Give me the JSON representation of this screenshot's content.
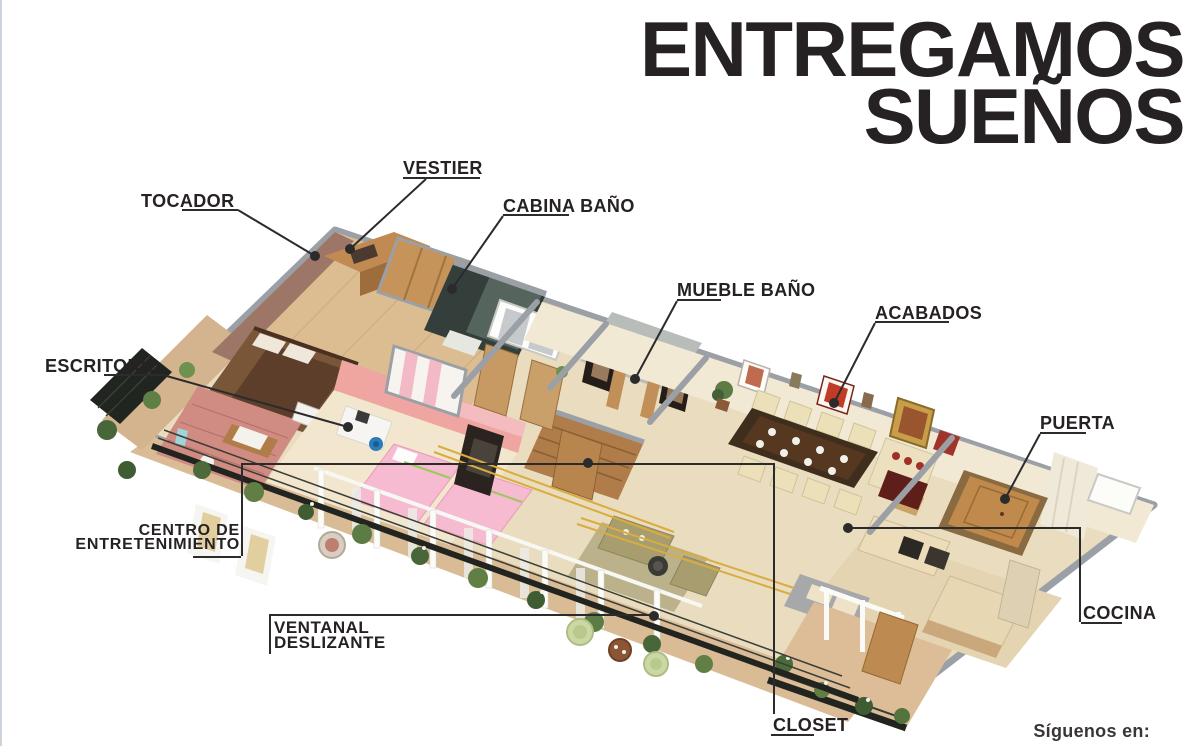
{
  "title": {
    "lines": [
      "ENTREGAMOS",
      "SUEÑOS"
    ]
  },
  "callouts": {
    "tocador": {
      "label": "TOCADOR"
    },
    "vestier": {
      "label": "VESTIER"
    },
    "cabina_bano": {
      "label": "CABINA BAÑO"
    },
    "mueble_bano": {
      "label": "MUEBLE BAÑO"
    },
    "acabados": {
      "label": "ACABADOS"
    },
    "puerta": {
      "label": "PUERTA"
    },
    "escritorio": {
      "label": "ESCRITORIO"
    },
    "centro_entretenimiento": {
      "label_line1": "CENTRO DE",
      "label_line2": "ENTRETENIMIENTO"
    },
    "ventanal_deslizante": {
      "label_line1": "VENTANAL",
      "label_line2": "DESLIZANTE"
    },
    "closet": {
      "label": "CLOSET"
    },
    "cocina": {
      "label": "COCINA"
    }
  },
  "footer": {
    "follow_text": "Síguenos en:"
  },
  "palette": {
    "text": "#262123",
    "leader_line": "#2b2b2b",
    "background": "#ffffff",
    "floor_beige": "#eadcbe",
    "wall_gray": "#9aa0a6",
    "wood": "#b07c49",
    "pink_wall": "#efa5a1",
    "balcony_green": "#5d7c43",
    "gold_trim": "#d9ac3f",
    "dark_cabin": "#343f3b"
  }
}
